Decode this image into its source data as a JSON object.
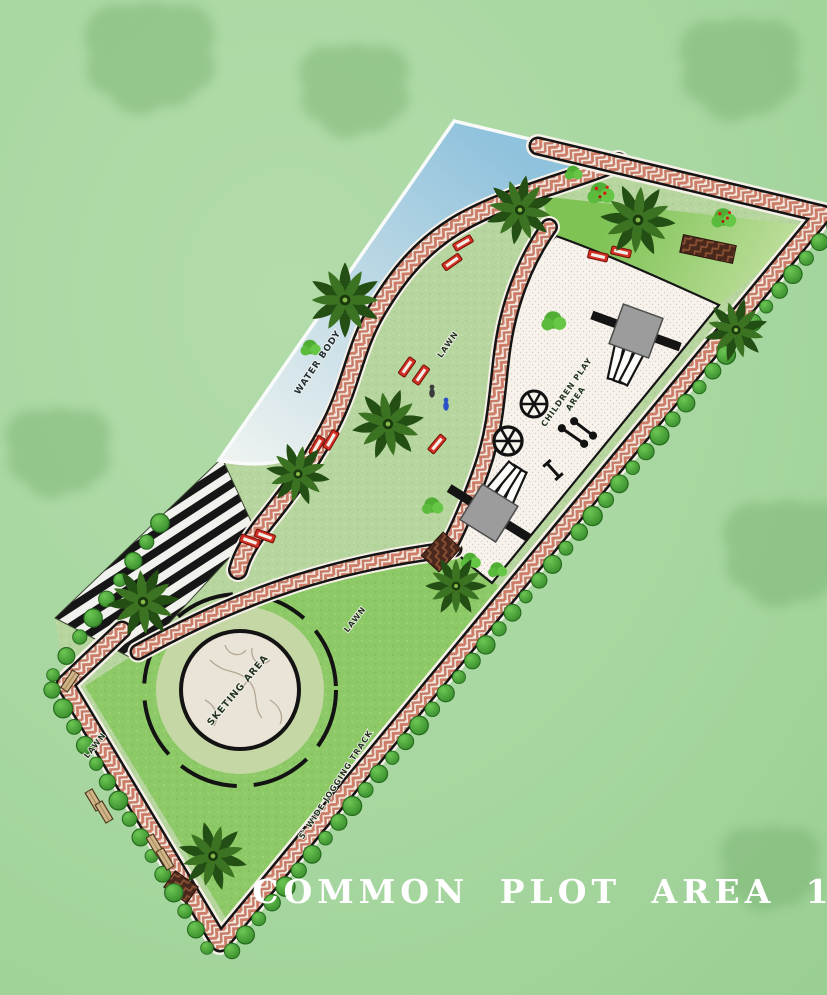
{
  "title": "COMMON PLOT AREA 1",
  "plan_labels": {
    "water_body": "WATER BODY",
    "lawn_upper": "LAWN",
    "lawn_mid": "LAWN",
    "lawn_lower": "LAWN",
    "children_play_line1": "CHILDREN PLAY",
    "children_play_line2": "AREA",
    "skating_area": "SKETING AREA",
    "jogging_track": "5' WIDE JOGGING TRACK"
  },
  "palette": {
    "background_grass": "#a7d7a0",
    "plot_lawn_sage": "#b7d59e",
    "lower_lawn_green": "#8dc967",
    "play_lawn_green": "#7fc355",
    "water_blue": "#8fc2dc",
    "path_brick_red": "#c9705a",
    "path_base_cream": "#f4ece2",
    "plaza_white": "#f7f3ec",
    "hedge_green": "#46a538",
    "palm_dark_green": "#234e14",
    "bench_red": "#d43024",
    "bench_tan": "#cfb587",
    "deck_stripe_black": "#161616",
    "skating_stone": "#eae3d7",
    "title_white": "#ffffff"
  },
  "icons": {
    "background_tree": "tree-canopy-icon",
    "palm_tree": "palm-tree-icon",
    "hedge_shrub": "hedge-shrub-icon",
    "flowering_shrub": "flowering-shrub-icon",
    "red_bench": "bench-red-icon",
    "tan_bench": "bench-tan-icon",
    "slide": "slide-icon",
    "merry_go_round": "merry-go-round-icon",
    "seesaw": "seesaw-icon",
    "balance_beam": "balance-beam-icon",
    "person": "person-icon"
  }
}
